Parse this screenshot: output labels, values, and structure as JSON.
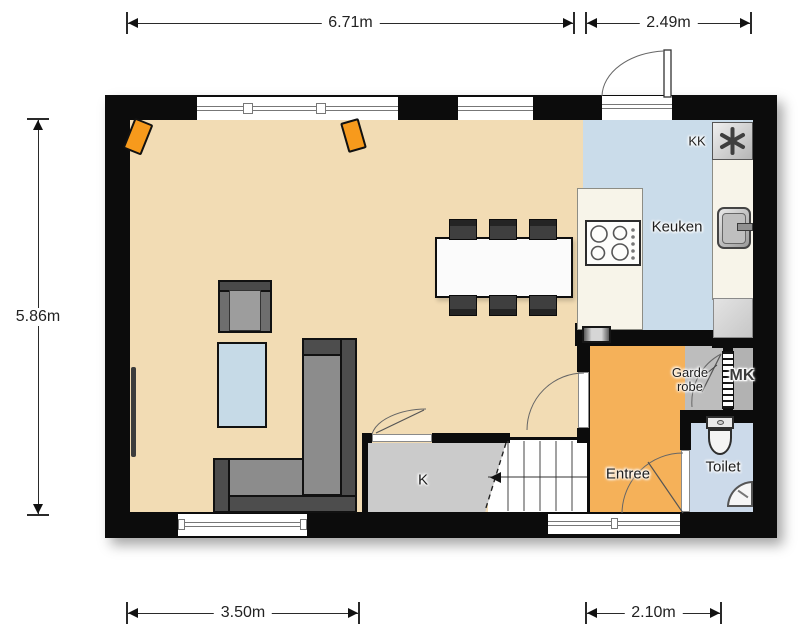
{
  "plan": {
    "dimensions": {
      "width_living_top": "6.71m",
      "width_kitchen_top": "2.49m",
      "height_left": "5.86m",
      "width_bottom_left": "3.50m",
      "width_bottom_right": "2.10m"
    },
    "rooms": {
      "keuken": "Keuken",
      "entree": "Entree",
      "toilet": "Toilet",
      "garderobe_line1": "Garde",
      "garderobe_line2": "robe",
      "meterkast": "MK",
      "closet_k": "K",
      "koelkast": "KK"
    },
    "icons": {
      "boiler": "asterisk-icon"
    },
    "colors": {
      "wall": "#0c0c0c",
      "living-floor": "#f2dcb4",
      "kitchen-floor": "#cadcea",
      "toilet-floor": "#ccdaea",
      "entree-floor": "#f5b159",
      "counter": "#f7f4e9",
      "closet-gray": "#cbcbcb",
      "garderobe-gray": "#bdbdbd",
      "mk-gray": "#b2b2b2",
      "speaker-orange": "#f79a1c",
      "sofa-frame": "#4d4d4d",
      "sofa-seat": "#8c8c8c",
      "table-blue": "#c6dae7"
    }
  }
}
